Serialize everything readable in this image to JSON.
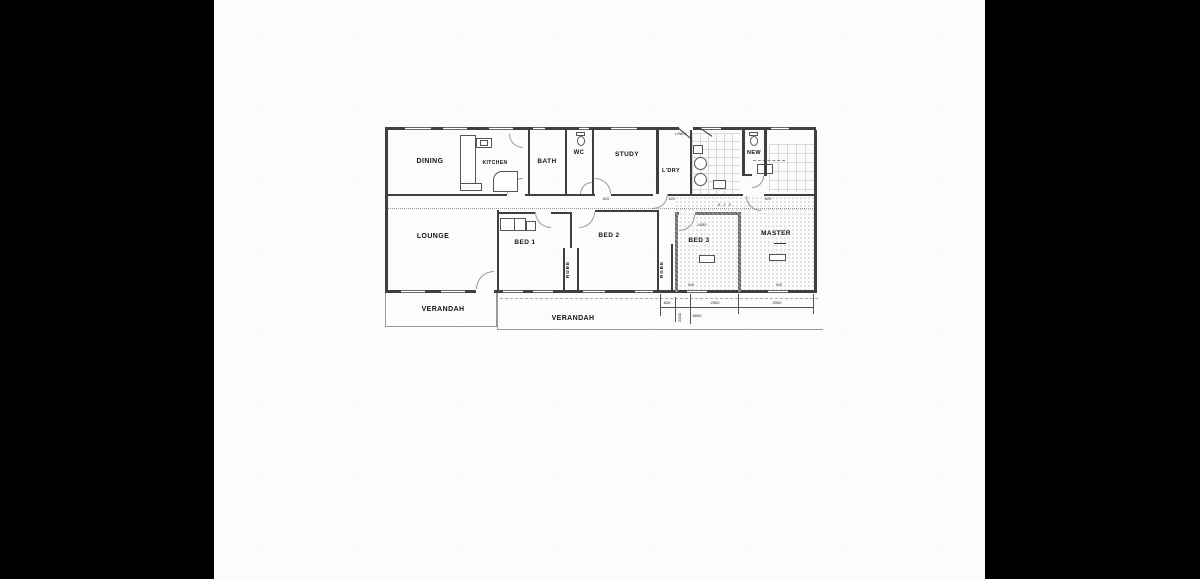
{
  "colors": {
    "bar": "#000000",
    "paper": "#fbfdfa",
    "wall": "#3f3f3f"
  },
  "rooms": {
    "dining": "DINING",
    "kitchen": "KITCHEN",
    "bath": "BATH",
    "wc": "WC",
    "study": "STUDY",
    "ldry": "L'DRY",
    "new_wc": "NEW",
    "lounge": "LOUNGE",
    "bed1": "BED 1",
    "bed2": "BED 2",
    "bed3": "BED 3",
    "master": "MASTER",
    "robe_a": "ROBE",
    "robe_b": "ROBE",
    "verandah_left": "VERANDAH",
    "verandah_bottom": "VERANDAH"
  },
  "annotations": {
    "linen": "LINEN",
    "door_tag": "820",
    "hall_tag": "820",
    "bed3_dim": "4050",
    "window_w4": "W4",
    "window_w2": "W2"
  },
  "dimensions": {
    "seg1": "820",
    "seg2": "2500",
    "seg3": "2000",
    "total": "8600",
    "vert": "2000"
  }
}
